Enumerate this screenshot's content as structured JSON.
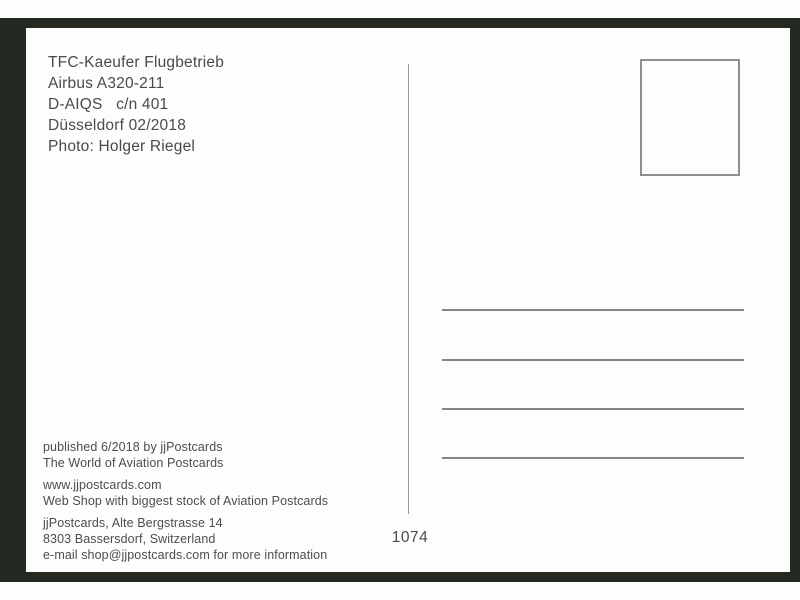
{
  "colors": {
    "frame": "#242922",
    "card": "#fdfdfd",
    "text": "#4a4a4a",
    "rule_lines": "#858585",
    "stamp_border": "#8f8f8f"
  },
  "postcard": {
    "sender_block": {
      "lines": [
        "TFC-Kaeufer Flugbetrieb",
        "Airbus A320-211",
        "D-AIQS   c/n 401",
        "Düsseldorf 02/2018",
        "Photo: Holger Riegel"
      ]
    },
    "publisher_block": {
      "published": "published 6/2018 by jjPostcards",
      "tagline": "The World of Aviation Postcards",
      "website": "www.jjpostcards.com",
      "webshop": "Web Shop with biggest stock of Aviation Postcards",
      "address_street": "jjPostcards, Alte Bergstrasse 14",
      "address_city": "8303 Bassersdorf, Switzerland",
      "email_line": "e-mail shop@jjpostcards.com for more information"
    },
    "card_number": "1074"
  }
}
